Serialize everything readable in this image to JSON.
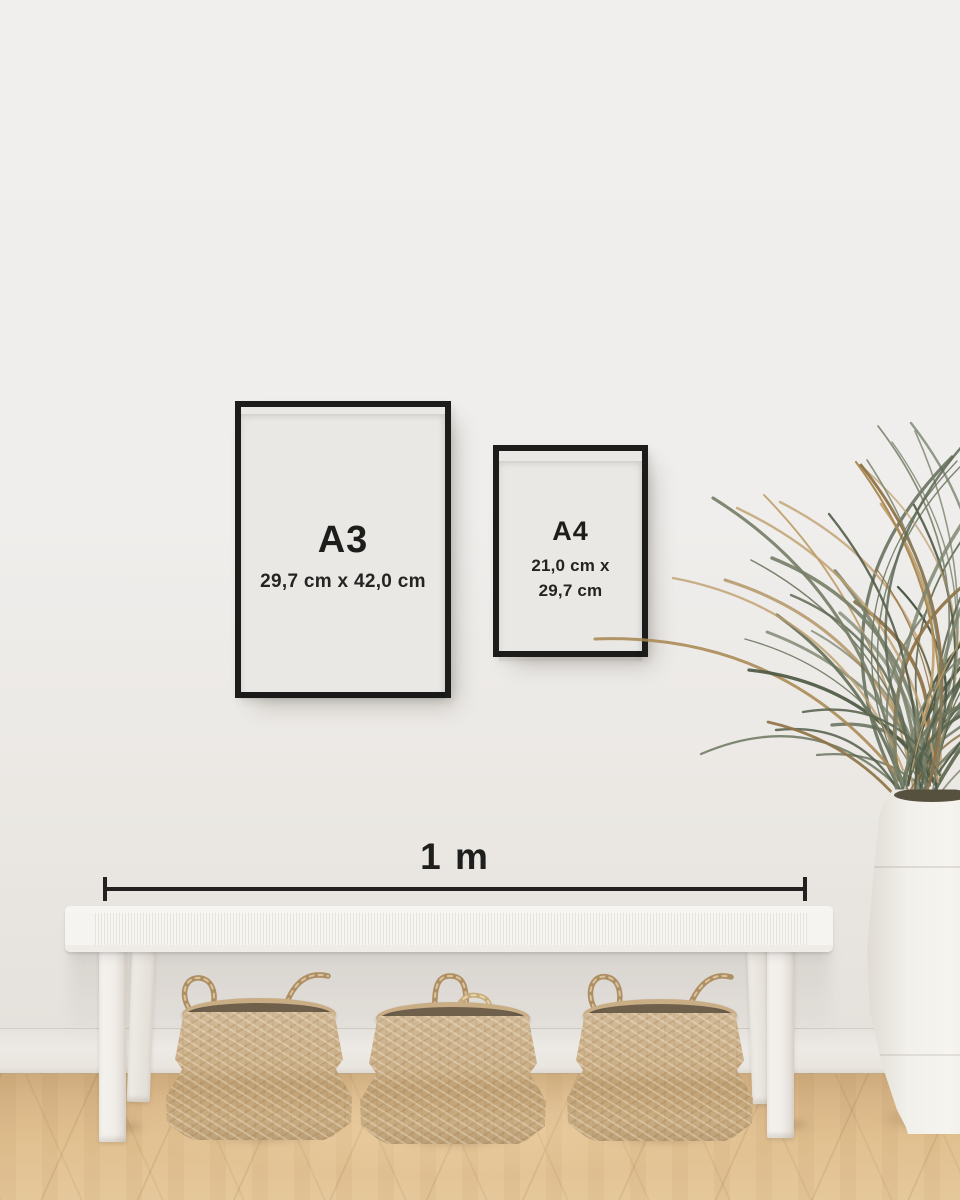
{
  "frames": {
    "a3": {
      "label": "A3",
      "dimensions": "29,7 cm x 42,0 cm"
    },
    "a4": {
      "label": "A4",
      "dimensions_line1": "21,0 cm x",
      "dimensions_line2": "29,7 cm"
    }
  },
  "ruler": {
    "label": "1 m"
  },
  "palette": {
    "wall": "#efeeec",
    "baseboard": "#eae6e1",
    "floor_wood": "#ddbb8c",
    "frame_border": "#1c1c1b",
    "frame_paper": "#e9e8e5",
    "text": "#1d1d1c",
    "ruler_line": "#222120",
    "bench_white": "#f6f4f1",
    "basket_weave": "#c9ad85",
    "basket_rim_interior": "#5f5445",
    "basket_rope": "#ae8f64",
    "plant_green": "#5c6752",
    "plant_tan": "#b3925f",
    "vase_white": "#f2f0eb"
  }
}
